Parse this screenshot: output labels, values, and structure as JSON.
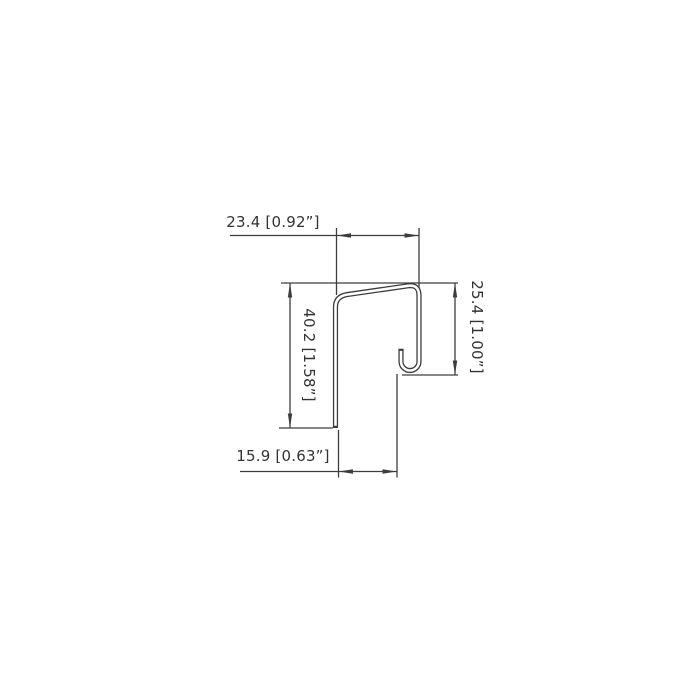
{
  "drawing": {
    "title": "J-profile cross-section dimension drawing",
    "background_color": "#ffffff",
    "line_color": "#3d3d3d",
    "text_color": "#333333",
    "dimensions": {
      "top": "23.4 [0.92”]",
      "right": "25.4 [1.00”]",
      "left": "40.2 [1.58”]",
      "bottom": "15.9 [0.63”]"
    }
  }
}
